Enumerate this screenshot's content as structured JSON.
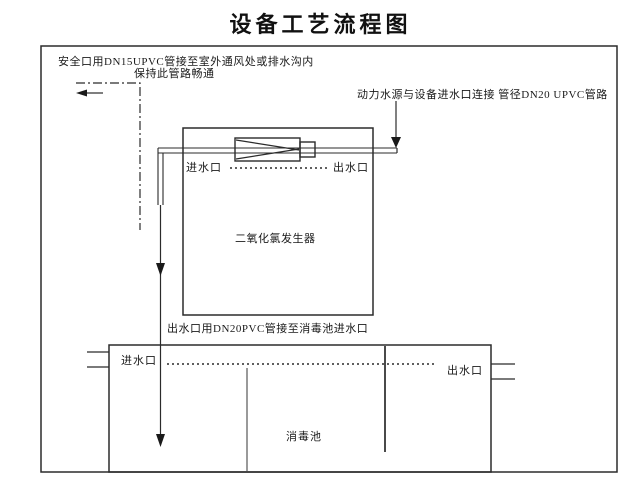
{
  "title": "设备工艺流程图",
  "annotations": {
    "safety_line1": "安全口用DN15UPVC管接至室外通风处或排水沟内",
    "safety_line2": "保持此管路畅通",
    "supply": "动力水源与设备进水口连接 管径DN20 UPVC管路",
    "outlet_pipe": "出水口用DN20PVC管接至消毒池进水口"
  },
  "generator": {
    "name": "二氧化氯发生器",
    "inlet": "进水口",
    "outlet": "出水口"
  },
  "pool": {
    "name": "消毒池",
    "inlet": "进水口",
    "outlet": "出水口"
  },
  "colors": {
    "line": "#2b2b2b",
    "text": "#1a1a1a",
    "baffle_light": "#9a9a9a",
    "baffle_dark": "#4a4a4a",
    "background": "#ffffff"
  }
}
